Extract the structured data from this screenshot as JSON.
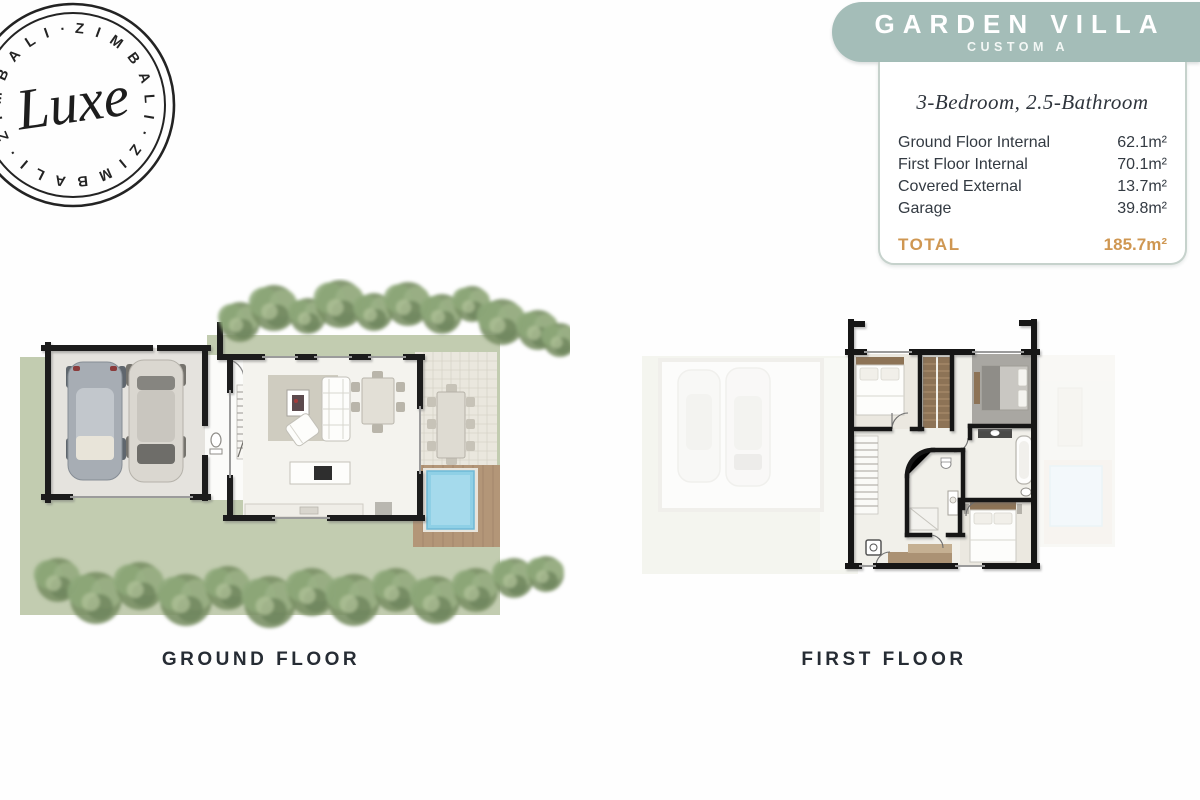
{
  "logo": {
    "ring_text": "Z I M B A L I  ·  Z I M B A L I  ·  Z I M B A L I  ·",
    "script": "Luxe"
  },
  "header": {
    "title": "GARDEN VILLA",
    "subtitle": "CUSTOM A",
    "band_color": "#a4bdb8"
  },
  "spec_card": {
    "headline": "3-Bedroom, 2.5-Bathroom",
    "rows": [
      {
        "label": "Ground Floor Internal",
        "value": "62.1m²"
      },
      {
        "label": "First Floor Internal",
        "value": "70.1m²"
      },
      {
        "label": "Covered External",
        "value": "13.7m²"
      },
      {
        "label": "Garage",
        "value": "39.8m²"
      }
    ],
    "total": {
      "label": "TOTAL",
      "value": "185.7m²",
      "color": "#cf9752"
    }
  },
  "plans": {
    "ground": {
      "label": "GROUND FLOOR"
    },
    "first": {
      "label": "FIRST FLOOR"
    }
  }
}
